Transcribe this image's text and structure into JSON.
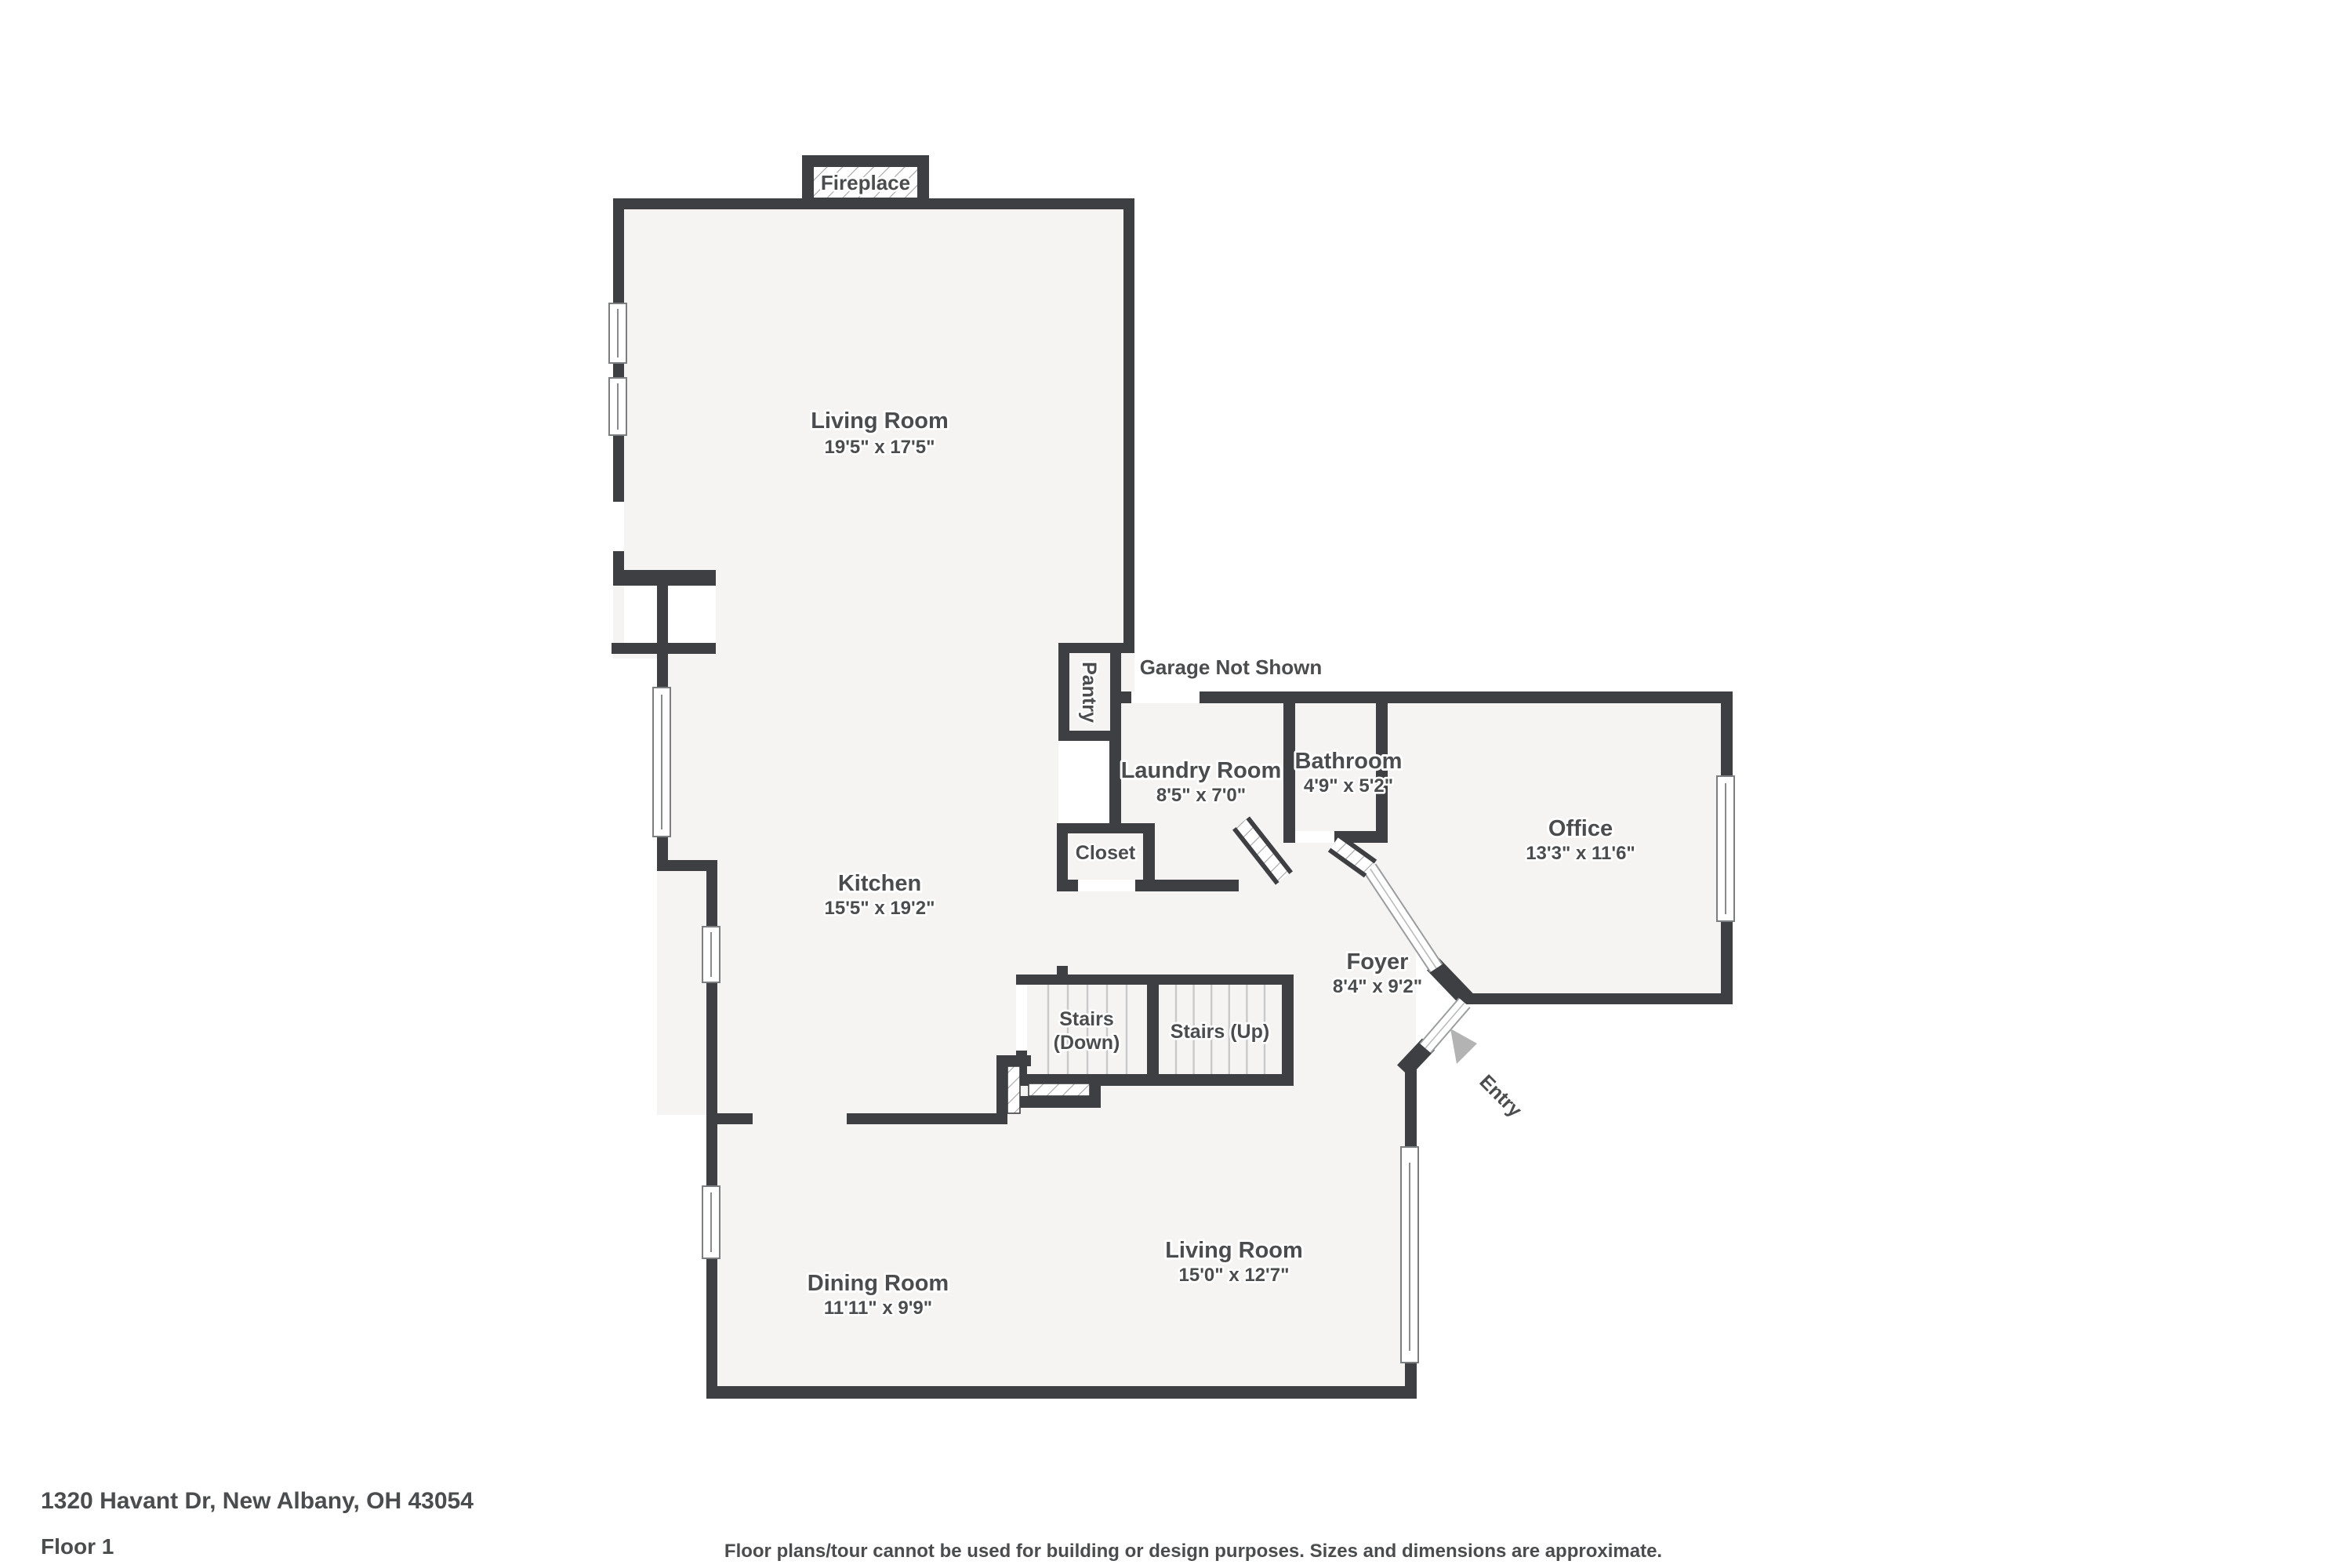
{
  "colors": {
    "wall": "#3d3f42",
    "floor": "#f5f4f3",
    "label_text": "#4a4c4e",
    "entry_arrow": "#b3b3b3",
    "hatch_line": "#a3a3a3"
  },
  "rooms": {
    "living_top": {
      "name": "Living Room",
      "dims": "19'5\" x 17'5\""
    },
    "kitchen": {
      "name": "Kitchen",
      "dims": "15'5\" x 19'2\""
    },
    "laundry": {
      "name": "Laundry Room",
      "dims": "8'5\" x 7'0\""
    },
    "bathroom": {
      "name": "Bathroom",
      "dims": "4'9\" x 5'2\""
    },
    "office": {
      "name": "Office",
      "dims": "13'3\" x 11'6\""
    },
    "closet": {
      "name": "Closet"
    },
    "pantry": {
      "name": "Pantry"
    },
    "foyer": {
      "name": "Foyer",
      "dims": "8'4\" x 9'2\""
    },
    "stairs_down": {
      "line1": "Stairs",
      "line2": "(Down)"
    },
    "stairs_up": {
      "name": "Stairs (Up)"
    },
    "living_bottom": {
      "name": "Living Room",
      "dims": "15'0\" x 12'7\""
    },
    "dining": {
      "name": "Dining Room",
      "dims": "11'11\" x 9'9\""
    }
  },
  "annotations": {
    "fireplace": "Fireplace",
    "garage": "Garage Not Shown",
    "entry": "Entry"
  },
  "footer": {
    "address": "1320 Havant Dr, New Albany, OH 43054",
    "floor": "Floor 1",
    "disclaimer": "Floor plans/tour cannot be used for building or design purposes. Sizes and dimensions are approximate."
  }
}
